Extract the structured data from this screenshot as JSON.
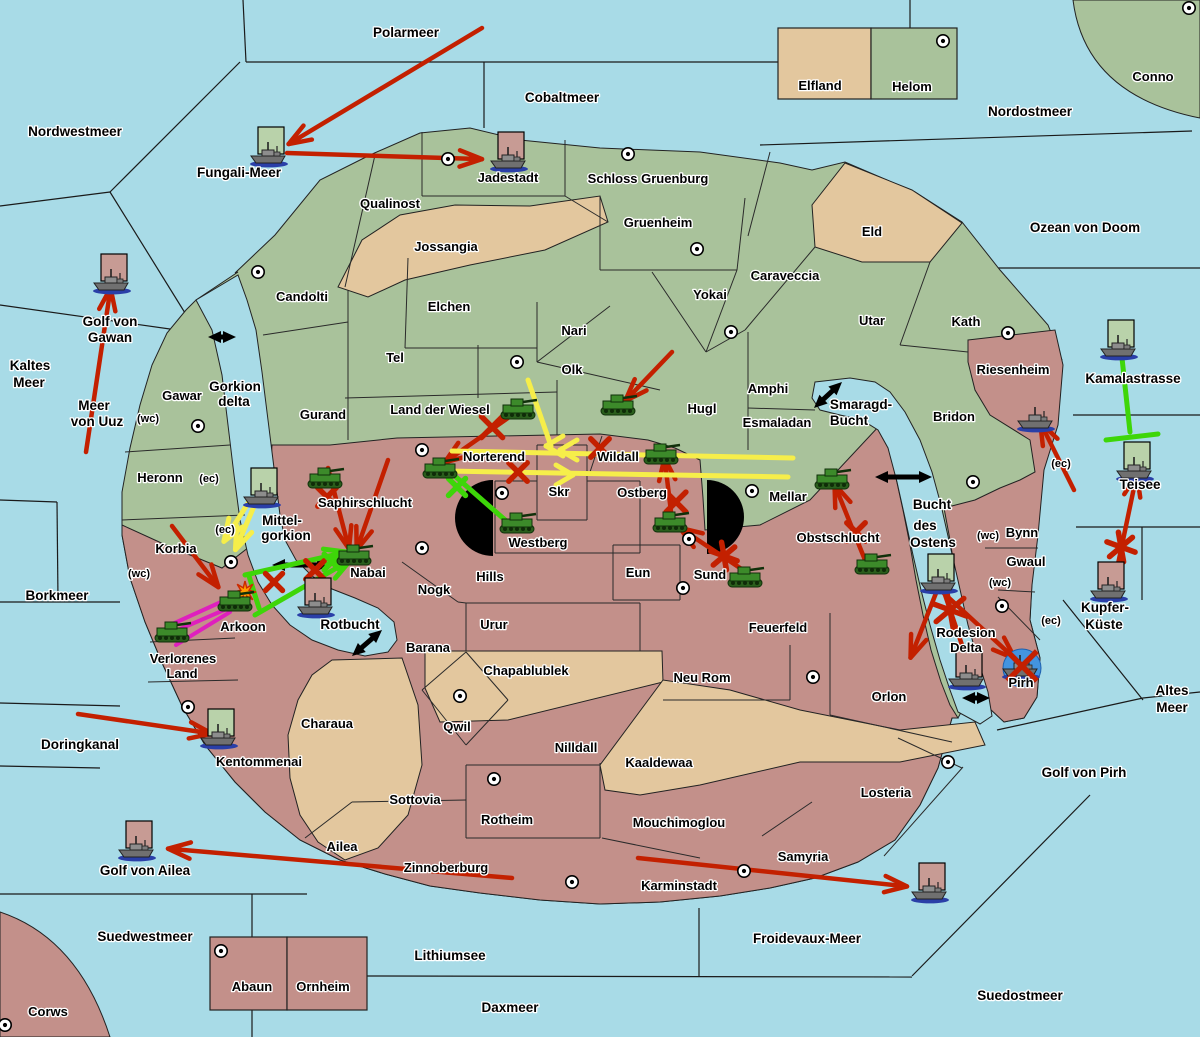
{
  "title": "Kriegskarte",
  "colors": {
    "sea": "#a8dbe7",
    "land_green": "#a9c29b",
    "land_tan": "#e3c79e",
    "land_pink": "#c3908a",
    "border": "#222222",
    "red": "#c32000",
    "yellow": "#f6ee4a",
    "green": "#3ed609",
    "magenta": "#df1fbe",
    "black": "#000000",
    "flag_green": "#b9d2aa",
    "flag_pink": "#c79b94",
    "sunk_blue": "#4394e0",
    "explosion": "#ff9d00",
    "tank": "#3c8a2a",
    "tank_dark": "#2a5e1c",
    "ship": "#707070",
    "ship_shadow": "#2a3fa8"
  },
  "sea_labels": [
    {
      "t": "Polarmeer",
      "x": 406,
      "y": 37
    },
    {
      "t": "Nordwestmeer",
      "x": 75,
      "y": 136
    },
    {
      "t": "Cobaltmeer",
      "x": 562,
      "y": 102
    },
    {
      "t": "Nordostmeer",
      "x": 1030,
      "y": 116
    },
    {
      "t": "Ozean von Doom",
      "x": 1085,
      "y": 232
    },
    {
      "t": "Fungali-Meer",
      "x": 239,
      "y": 177
    },
    {
      "t": "Kaltes",
      "x": 30,
      "y": 370
    },
    {
      "t": "Meer",
      "x": 29,
      "y": 387
    },
    {
      "t": "Golf von",
      "x": 110,
      "y": 326
    },
    {
      "t": "Gawan",
      "x": 110,
      "y": 342
    },
    {
      "t": "Meer",
      "x": 94,
      "y": 410
    },
    {
      "t": "von Uuz",
      "x": 97,
      "y": 426
    },
    {
      "t": "Borkmeer",
      "x": 57,
      "y": 600
    },
    {
      "t": "Doringkanal",
      "x": 80,
      "y": 749
    },
    {
      "t": "Golf von Ailea",
      "x": 145,
      "y": 875
    },
    {
      "t": "Suedwestmeer",
      "x": 145,
      "y": 941
    },
    {
      "t": "Lithiumsee",
      "x": 450,
      "y": 960
    },
    {
      "t": "Daxmeer",
      "x": 510,
      "y": 1012
    },
    {
      "t": "Suedostmeer",
      "x": 1020,
      "y": 1000
    },
    {
      "t": "Froidevaux-Meer",
      "x": 807,
      "y": 943
    },
    {
      "t": "Golf von Pirh",
      "x": 1084,
      "y": 777
    },
    {
      "t": "Altes",
      "x": 1172,
      "y": 695
    },
    {
      "t": "Meer",
      "x": 1172,
      "y": 712
    },
    {
      "t": "Kupfer-",
      "x": 1105,
      "y": 612
    },
    {
      "t": "Küste",
      "x": 1104,
      "y": 629
    },
    {
      "t": "Kamalastrasse",
      "x": 1133,
      "y": 383
    },
    {
      "t": "Teisee",
      "x": 1140,
      "y": 489
    }
  ],
  "water_labels": [
    {
      "t": "Gorkion",
      "x": 235,
      "y": 391
    },
    {
      "t": "delta",
      "x": 234,
      "y": 406
    },
    {
      "t": "Mittel-",
      "x": 282,
      "y": 525
    },
    {
      "t": "gorkion",
      "x": 286,
      "y": 540
    },
    {
      "t": "Smaragd-",
      "x": 861,
      "y": 409
    },
    {
      "t": "Bucht",
      "x": 849,
      "y": 425
    },
    {
      "t": "Bucht",
      "x": 932,
      "y": 509
    },
    {
      "t": "des",
      "x": 925,
      "y": 530
    },
    {
      "t": "Ostens",
      "x": 933,
      "y": 547
    },
    {
      "t": "Rotbucht",
      "x": 350,
      "y": 629
    }
  ],
  "land_labels": [
    {
      "t": "Elfland",
      "x": 820,
      "y": 90
    },
    {
      "t": "Helom",
      "x": 912,
      "y": 91
    },
    {
      "t": "Conno",
      "x": 1153,
      "y": 81
    },
    {
      "t": "Jadestadt",
      "x": 508,
      "y": 182
    },
    {
      "t": "Schloss Gruenburg",
      "x": 648,
      "y": 183
    },
    {
      "t": "Qualinost",
      "x": 390,
      "y": 208
    },
    {
      "t": "Jossangia",
      "x": 446,
      "y": 251
    },
    {
      "t": "Gruenheim",
      "x": 658,
      "y": 227
    },
    {
      "t": "Eld",
      "x": 872,
      "y": 236
    },
    {
      "t": "Caraveccia",
      "x": 785,
      "y": 280
    },
    {
      "t": "Candolti",
      "x": 302,
      "y": 301
    },
    {
      "t": "Elchen",
      "x": 449,
      "y": 311
    },
    {
      "t": "Yokai",
      "x": 710,
      "y": 299
    },
    {
      "t": "Nari",
      "x": 574,
      "y": 335
    },
    {
      "t": "Utar",
      "x": 872,
      "y": 325
    },
    {
      "t": "Kath",
      "x": 966,
      "y": 326
    },
    {
      "t": "Tel",
      "x": 395,
      "y": 362
    },
    {
      "t": "Olk",
      "x": 572,
      "y": 374
    },
    {
      "t": "Gawar",
      "x": 182,
      "y": 400
    },
    {
      "t": "Gurand",
      "x": 323,
      "y": 419
    },
    {
      "t": "Land der Wiesel",
      "x": 440,
      "y": 414
    },
    {
      "t": "Hugl",
      "x": 702,
      "y": 413
    },
    {
      "t": "Amphi",
      "x": 768,
      "y": 393
    },
    {
      "t": "Esmaladan",
      "x": 777,
      "y": 427
    },
    {
      "t": "Riesenheim",
      "x": 1013,
      "y": 374
    },
    {
      "t": "Bridon",
      "x": 954,
      "y": 421
    },
    {
      "t": "Heronn",
      "x": 160,
      "y": 482
    },
    {
      "t": "Norterend",
      "x": 494,
      "y": 461
    },
    {
      "t": "Wildall",
      "x": 618,
      "y": 461
    },
    {
      "t": "Skr",
      "x": 559,
      "y": 496
    },
    {
      "t": "Ostberg",
      "x": 642,
      "y": 497
    },
    {
      "t": "Mellar",
      "x": 788,
      "y": 501
    },
    {
      "t": "Saphirschlucht",
      "x": 365,
      "y": 507
    },
    {
      "t": "Korbia",
      "x": 176,
      "y": 553
    },
    {
      "t": "Westberg",
      "x": 538,
      "y": 547
    },
    {
      "t": "Eun",
      "x": 638,
      "y": 577
    },
    {
      "t": "Sund",
      "x": 710,
      "y": 579
    },
    {
      "t": "Obstschlucht",
      "x": 838,
      "y": 542
    },
    {
      "t": "Bynn",
      "x": 1022,
      "y": 537
    },
    {
      "t": "Gwaul",
      "x": 1026,
      "y": 566
    },
    {
      "t": "Nabai",
      "x": 368,
      "y": 577
    },
    {
      "t": "Nogk",
      "x": 434,
      "y": 594
    },
    {
      "t": "Hills",
      "x": 490,
      "y": 581
    },
    {
      "t": "Urur",
      "x": 494,
      "y": 629
    },
    {
      "t": "Feuerfeld",
      "x": 778,
      "y": 632
    },
    {
      "t": "Rodesion",
      "x": 966,
      "y": 637
    },
    {
      "t": "Delta",
      "x": 966,
      "y": 652
    },
    {
      "t": "Arkoon",
      "x": 243,
      "y": 631
    },
    {
      "t": "Verlorenes",
      "x": 183,
      "y": 663
    },
    {
      "t": "Land",
      "x": 182,
      "y": 678
    },
    {
      "t": "Barana",
      "x": 428,
      "y": 652
    },
    {
      "t": "Chapablublek",
      "x": 526,
      "y": 675
    },
    {
      "t": "Neu Rom",
      "x": 702,
      "y": 682
    },
    {
      "t": "Orlon",
      "x": 889,
      "y": 701
    },
    {
      "t": "Pirh",
      "x": 1021,
      "y": 687
    },
    {
      "t": "Charaua",
      "x": 327,
      "y": 728
    },
    {
      "t": "Qwil",
      "x": 457,
      "y": 731
    },
    {
      "t": "Nilldall",
      "x": 576,
      "y": 752
    },
    {
      "t": "Kaaldewaa",
      "x": 659,
      "y": 767
    },
    {
      "t": "Kentommenai",
      "x": 259,
      "y": 766
    },
    {
      "t": "Sottovia",
      "x": 415,
      "y": 804
    },
    {
      "t": "Rotheim",
      "x": 507,
      "y": 824
    },
    {
      "t": "Mouchimoglou",
      "x": 679,
      "y": 827
    },
    {
      "t": "Losteria",
      "x": 886,
      "y": 797
    },
    {
      "t": "Ailea",
      "x": 342,
      "y": 851
    },
    {
      "t": "Zinnoberburg",
      "x": 446,
      "y": 872
    },
    {
      "t": "Karminstadt",
      "x": 679,
      "y": 890
    },
    {
      "t": "Samyria",
      "x": 803,
      "y": 861
    },
    {
      "t": "Abaun",
      "x": 252,
      "y": 991
    },
    {
      "t": "Ornheim",
      "x": 323,
      "y": 991
    },
    {
      "t": "Corws",
      "x": 48,
      "y": 1016
    }
  ],
  "annotations": [
    {
      "t": "(wc)",
      "x": 148,
      "y": 422
    },
    {
      "t": "(ec)",
      "x": 209,
      "y": 482
    },
    {
      "t": "(ec)",
      "x": 225,
      "y": 533
    },
    {
      "t": "(wc)",
      "x": 139,
      "y": 577
    },
    {
      "t": "(ec)",
      "x": 1061,
      "y": 467
    },
    {
      "t": "(wc)",
      "x": 988,
      "y": 539
    },
    {
      "t": "(wc)",
      "x": 1000,
      "y": 586
    },
    {
      "t": "(ec)",
      "x": 1051,
      "y": 624
    }
  ],
  "cities": [
    [
      258,
      272
    ],
    [
      448,
      159
    ],
    [
      628,
      154
    ],
    [
      697,
      249
    ],
    [
      943,
      41
    ],
    [
      1189,
      8
    ],
    [
      198,
      426
    ],
    [
      517,
      362
    ],
    [
      731,
      332
    ],
    [
      1008,
      333
    ],
    [
      973,
      482
    ],
    [
      422,
      450
    ],
    [
      502,
      493
    ],
    [
      752,
      491
    ],
    [
      422,
      548
    ],
    [
      689,
      539
    ],
    [
      683,
      588
    ],
    [
      231,
      562
    ],
    [
      188,
      707
    ],
    [
      460,
      696
    ],
    [
      494,
      779
    ],
    [
      572,
      882
    ],
    [
      744,
      871
    ],
    [
      948,
      762
    ],
    [
      813,
      677
    ],
    [
      1002,
      606
    ],
    [
      221,
      951
    ],
    [
      5,
      1025
    ]
  ],
  "tanks": [
    [
      518,
      410
    ],
    [
      618,
      406
    ],
    [
      661,
      455
    ],
    [
      440,
      469
    ],
    [
      325,
      479
    ],
    [
      354,
      556
    ],
    [
      517,
      524
    ],
    [
      670,
      523
    ],
    [
      745,
      578
    ],
    [
      832,
      480
    ],
    [
      872,
      565
    ],
    [
      235,
      602
    ],
    [
      172,
      633
    ]
  ],
  "ships": [
    {
      "x": 270,
      "y": 155,
      "flag": "green"
    },
    {
      "x": 113,
      "y": 282,
      "flag": "pink"
    },
    {
      "x": 510,
      "y": 160,
      "flag": "pink"
    },
    {
      "x": 263,
      "y": 496,
      "flag": "green"
    },
    {
      "x": 317,
      "y": 606,
      "flag": "pink"
    },
    {
      "x": 1037,
      "y": 420,
      "flag": null
    },
    {
      "x": 1120,
      "y": 348,
      "flag": "green"
    },
    {
      "x": 1136,
      "y": 470,
      "flag": "green"
    },
    {
      "x": 1110,
      "y": 590,
      "flag": "pink"
    },
    {
      "x": 940,
      "y": 582,
      "flag": "green"
    },
    {
      "x": 968,
      "y": 678,
      "flag": "pink"
    },
    {
      "x": 220,
      "y": 737,
      "flag": "green"
    },
    {
      "x": 138,
      "y": 849,
      "flag": "pink"
    },
    {
      "x": 931,
      "y": 891,
      "flag": "pink"
    }
  ],
  "sunk_ship": {
    "x": 1022,
    "y": 668
  },
  "explosion": {
    "x": 245,
    "y": 592
  },
  "arrows": [
    {
      "c": "red",
      "p": [
        [
          482,
          28
        ],
        [
          292,
          142
        ]
      ],
      "h": 1
    },
    {
      "c": "red",
      "p": [
        [
          287,
          153
        ],
        [
          478,
          159
        ]
      ],
      "h": 1
    },
    {
      "c": "red",
      "p": [
        [
          86,
          452
        ],
        [
          110,
          292
        ]
      ],
      "h": 1
    },
    {
      "c": "red",
      "p": [
        [
          672,
          352
        ],
        [
          628,
          398
        ]
      ],
      "h": 1
    },
    {
      "c": "red",
      "p": [
        [
          515,
          413
        ],
        [
          448,
          460
        ]
      ],
      "h": 1
    },
    {
      "c": "red",
      "p": [
        [
          328,
          468
        ],
        [
          348,
          545
        ]
      ],
      "h": 1
    },
    {
      "c": "red",
      "p": [
        [
          388,
          460
        ],
        [
          358,
          546
        ]
      ],
      "h": 1
    },
    {
      "c": "red",
      "p": [
        [
          172,
          526
        ],
        [
          216,
          584
        ]
      ],
      "h": 1
    },
    {
      "c": "red",
      "p": [
        [
          672,
          520
        ],
        [
          665,
          462
        ]
      ],
      "h": 1
    },
    {
      "c": "red",
      "p": [
        [
          746,
          572
        ],
        [
          683,
          530
        ]
      ],
      "h": 1
    },
    {
      "c": "red",
      "p": [
        [
          865,
          560
        ],
        [
          836,
          488
        ]
      ],
      "h": 1
    },
    {
      "c": "red",
      "p": [
        [
          1074,
          490
        ],
        [
          1042,
          426
        ]
      ],
      "h": 1
    },
    {
      "c": "red",
      "p": [
        [
          1113,
          588
        ],
        [
          1136,
          478
        ]
      ],
      "h": 1
    },
    {
      "c": "red",
      "p": [
        [
          936,
          586
        ],
        [
          1012,
          656
        ]
      ],
      "h": 1
    },
    {
      "c": "red",
      "p": [
        [
          938,
          588
        ],
        [
          912,
          654
        ]
      ],
      "h": 1
    },
    {
      "c": "red",
      "p": [
        [
          942,
          586
        ],
        [
          962,
          645
        ]
      ],
      "h": 0
    },
    {
      "c": "red",
      "p": [
        [
          78,
          714
        ],
        [
          208,
          733
        ]
      ],
      "h": 1
    },
    {
      "c": "red",
      "p": [
        [
          512,
          878
        ],
        [
          172,
          849
        ]
      ],
      "h": 1
    },
    {
      "c": "red",
      "p": [
        [
          638,
          858
        ],
        [
          903,
          886
        ]
      ],
      "h": 1
    },
    {
      "c": "yellow",
      "p": [
        [
          258,
          497
        ],
        [
          237,
          546
        ]
      ],
      "h": 1
    },
    {
      "c": "yellow",
      "p": [
        [
          250,
          500
        ],
        [
          226,
          538
        ]
      ],
      "h": 1
    },
    {
      "c": "yellow",
      "p": [
        [
          452,
          451
        ],
        [
          793,
          458
        ]
      ],
      "h": 0
    },
    {
      "c": "yellow",
      "p": [
        [
          446,
          471
        ],
        [
          788,
          477
        ]
      ],
      "h": 0
    },
    {
      "c": "yellow",
      "p": [
        [
          528,
          380
        ],
        [
          551,
          446
        ]
      ],
      "h": 0
    },
    {
      "c": "green",
      "p": [
        [
          448,
          470
        ],
        [
          512,
          526
        ]
      ],
      "h": 0
    },
    {
      "c": "green",
      "p": [
        [
          245,
          575
        ],
        [
          343,
          553
        ]
      ],
      "h": 1
    },
    {
      "c": "green",
      "p": [
        [
          255,
          615
        ],
        [
          347,
          562
        ]
      ],
      "h": 1
    },
    {
      "c": "green",
      "p": [
        [
          249,
          576
        ],
        [
          259,
          608
        ]
      ],
      "h": 0
    },
    {
      "c": "green",
      "p": [
        [
          1122,
          358
        ],
        [
          1130,
          432
        ]
      ],
      "h": 0
    },
    {
      "c": "green",
      "p": [
        [
          1106,
          440
        ],
        [
          1158,
          434
        ]
      ],
      "h": 0
    },
    {
      "c": "magenta",
      "p": [
        [
          168,
          626
        ],
        [
          232,
          597
        ]
      ],
      "h": 0
    },
    {
      "c": "magenta",
      "p": [
        [
          164,
          636
        ],
        [
          238,
          604
        ]
      ],
      "h": 0
    },
    {
      "c": "magenta",
      "p": [
        [
          176,
          645
        ],
        [
          230,
          612
        ]
      ],
      "h": 0
    }
  ],
  "chevrons": [
    {
      "x": 549,
      "y": 446,
      "dir": "left"
    },
    {
      "x": 563,
      "y": 450,
      "dir": "left"
    },
    {
      "x": 570,
      "y": 475,
      "dir": "right"
    }
  ],
  "crosses": [
    {
      "x": 492,
      "y": 427,
      "c": "red",
      "s": 30,
      "a": 2
    },
    {
      "x": 327,
      "y": 497,
      "c": "red",
      "s": 26,
      "a": 2
    },
    {
      "x": 600,
      "y": 448,
      "c": "red",
      "s": 26,
      "a": 2
    },
    {
      "x": 518,
      "y": 472,
      "c": "red",
      "s": 26,
      "a": 2
    },
    {
      "x": 676,
      "y": 502,
      "c": "red",
      "s": 28,
      "a": 2
    },
    {
      "x": 724,
      "y": 556,
      "c": "red",
      "s": 28,
      "a": 3
    },
    {
      "x": 856,
      "y": 532,
      "c": "red",
      "s": 26,
      "a": 2
    },
    {
      "x": 950,
      "y": 610,
      "c": "red",
      "s": 36,
      "a": 3
    },
    {
      "x": 1121,
      "y": 547,
      "c": "red",
      "s": 30,
      "a": 3
    },
    {
      "x": 457,
      "y": 487,
      "c": "green",
      "s": 24,
      "a": 2
    },
    {
      "x": 274,
      "y": 582,
      "c": "red",
      "s": 24,
      "a": 2
    },
    {
      "x": 315,
      "y": 570,
      "c": "red",
      "s": 26,
      "a": 2
    },
    {
      "x": 332,
      "y": 562,
      "c": "green",
      "s": 22,
      "a": 2
    }
  ],
  "portage_arrows": [
    [
      208,
      337,
      236,
      337
    ],
    [
      272,
      565,
      330,
      565
    ],
    [
      814,
      408,
      842,
      382
    ],
    [
      875,
      477,
      932,
      477
    ],
    [
      352,
      656,
      382,
      630
    ],
    [
      962,
      698,
      990,
      698
    ]
  ],
  "mountains": [
    {
      "cx": 493,
      "cy": 518,
      "r": 38,
      "flat": "right"
    },
    {
      "cx": 707,
      "cy": 517,
      "r": 37,
      "flat": "left"
    }
  ]
}
